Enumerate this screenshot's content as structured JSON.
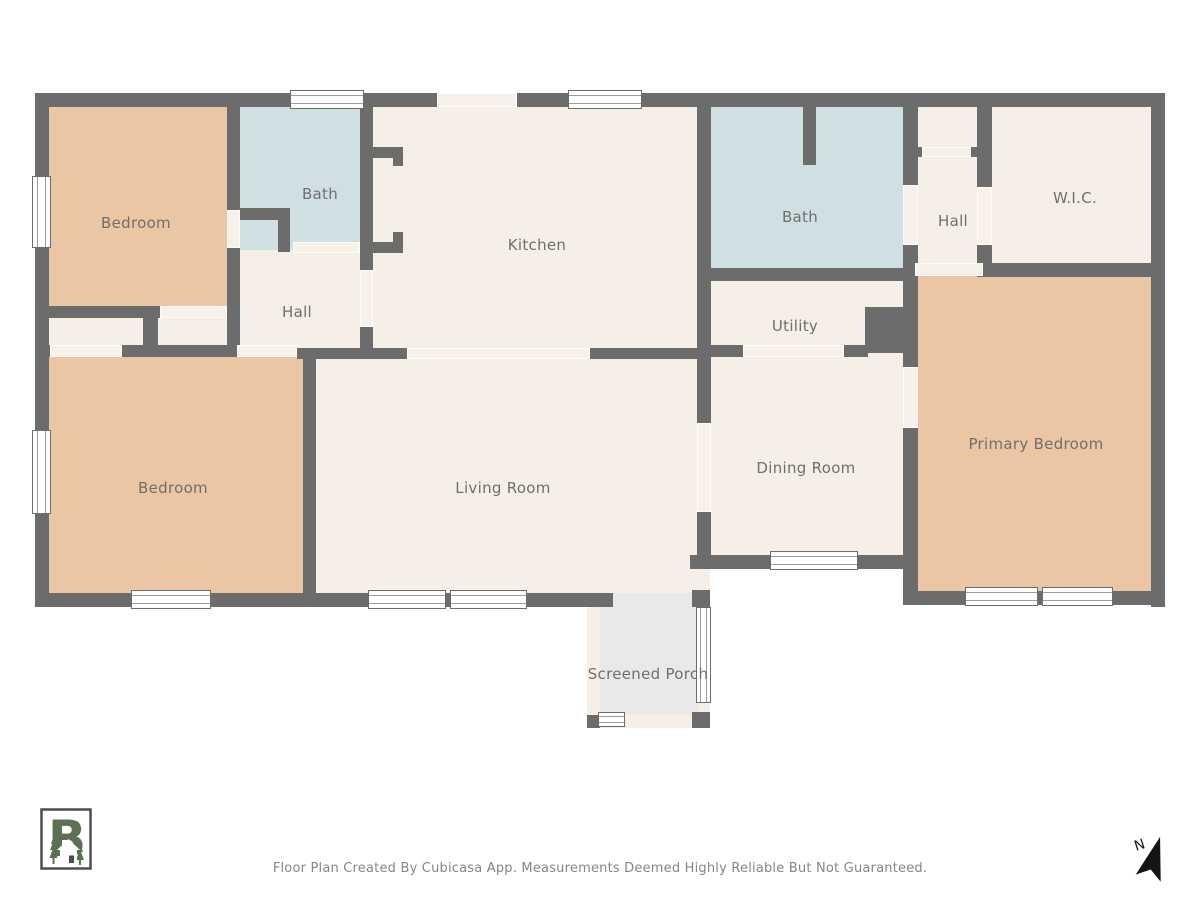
{
  "colors": {
    "wall": "#6c6c6c",
    "floor": "#f6efe7",
    "bedroom": "#ebc6a4",
    "bath": "#cfdfe2",
    "porch": "#e9e9e9",
    "opening": "#f8f1e9",
    "window_fill": "#ffffff",
    "window_frame": "#6c6c6c",
    "window_line": "#9c9c9c",
    "label": "#6f6f6f",
    "logo_green": "#5c7154",
    "footer_text": "#868686"
  },
  "footer": {
    "disclaimer": "Floor Plan Created By Cubicasa App. Measurements Deemed Highly Reliable But Not Guaranteed."
  },
  "north": {
    "label": "N"
  },
  "icons": {
    "logo": "cubicasa-house-logo",
    "north": "north-arrow-icon"
  },
  "plan": {
    "fills": [
      {
        "name": "closets-floor",
        "x": 35,
        "y": 302,
        "w": 203,
        "h": 55,
        "color": "floor"
      },
      {
        "name": "hall-left-floor",
        "x": 227,
        "y": 245,
        "w": 146,
        "h": 112,
        "color": "floor"
      },
      {
        "name": "hall-left-pocket-floor",
        "x": 228,
        "y": 214,
        "w": 64,
        "h": 38,
        "color": "floor"
      },
      {
        "name": "bath-left-floor",
        "x": 237,
        "y": 100,
        "w": 136,
        "h": 150,
        "color": "bath"
      },
      {
        "name": "bedroom-topleft-floor",
        "x": 43,
        "y": 100,
        "w": 195,
        "h": 208,
        "color": "bedroom"
      },
      {
        "name": "kitchen-floor",
        "x": 360,
        "y": 100,
        "w": 350,
        "h": 257,
        "color": "floor"
      },
      {
        "name": "bath-right-floor",
        "x": 703,
        "y": 100,
        "w": 202,
        "h": 170,
        "color": "bath"
      },
      {
        "name": "utility-floor",
        "x": 703,
        "y": 270,
        "w": 202,
        "h": 87,
        "color": "floor"
      },
      {
        "name": "hall-right-floor",
        "x": 908,
        "y": 100,
        "w": 84,
        "h": 177,
        "color": "floor"
      },
      {
        "name": "wic-floor",
        "x": 983,
        "y": 100,
        "w": 182,
        "h": 177,
        "color": "floor"
      },
      {
        "name": "dining-room-floor",
        "x": 697,
        "y": 355,
        "w": 221,
        "h": 214,
        "color": "floor"
      },
      {
        "name": "living-room-floor",
        "x": 310,
        "y": 348,
        "w": 400,
        "h": 247,
        "color": "floor"
      },
      {
        "name": "bedroom-bottomleft-floor",
        "x": 43,
        "y": 355,
        "w": 272,
        "h": 240,
        "color": "bedroom"
      },
      {
        "name": "primary-bedroom-floor",
        "x": 915,
        "y": 273,
        "w": 242,
        "h": 322,
        "color": "bedroom"
      },
      {
        "name": "screened-porch-floor",
        "x": 600,
        "y": 593,
        "w": 98,
        "h": 124,
        "color": "porch"
      },
      {
        "name": "porch-screen-left",
        "x": 587,
        "y": 605,
        "w": 13,
        "h": 112,
        "color": "floor"
      },
      {
        "name": "porch-screen-bottom",
        "x": 598,
        "y": 715,
        "w": 94,
        "h": 13,
        "color": "floor"
      },
      {
        "name": "porch-screen-right",
        "x": 698,
        "y": 607,
        "w": 12,
        "h": 107,
        "color": "floor"
      }
    ],
    "walls": [
      {
        "name": "exterior-wall-top",
        "x": 35,
        "y": 93,
        "w": 1130,
        "h": 14
      },
      {
        "name": "exterior-wall-left",
        "x": 35,
        "y": 93,
        "w": 14,
        "h": 514
      },
      {
        "name": "exterior-wall-right",
        "x": 1151,
        "y": 93,
        "w": 14,
        "h": 514
      },
      {
        "name": "exterior-wall-bottom-left",
        "x": 35,
        "y": 593,
        "w": 578,
        "h": 14
      },
      {
        "name": "dining-bottom-wall",
        "x": 690,
        "y": 555,
        "w": 228,
        "h": 14
      },
      {
        "name": "primary-bottom-wall",
        "x": 905,
        "y": 591,
        "w": 260,
        "h": 14
      },
      {
        "name": "porch-post-topright",
        "x": 692,
        "y": 590,
        "w": 18,
        "h": 17
      },
      {
        "name": "porch-post-bottomleft",
        "x": 587,
        "y": 715,
        "w": 13,
        "h": 13
      },
      {
        "name": "porch-post-bottomright",
        "x": 692,
        "y": 712,
        "w": 18,
        "h": 16
      },
      {
        "name": "bedroom1-right-wall-upper",
        "x": 227,
        "y": 100,
        "w": 13,
        "h": 110
      },
      {
        "name": "bedroom1-right-wall-lower",
        "x": 227,
        "y": 248,
        "w": 13,
        "h": 104
      },
      {
        "name": "bath1-l-wall-horizontal",
        "x": 232,
        "y": 208,
        "w": 58,
        "h": 12
      },
      {
        "name": "bath1-l-wall-vertical",
        "x": 278,
        "y": 208,
        "w": 12,
        "h": 44
      },
      {
        "name": "kitchen-left-wall",
        "x": 360,
        "y": 98,
        "w": 13,
        "h": 172
      },
      {
        "name": "kitchen-pantry-stub-top",
        "x": 372,
        "y": 147,
        "w": 31,
        "h": 11
      },
      {
        "name": "kitchen-pantry-jamb-top",
        "x": 393,
        "y": 156,
        "w": 10,
        "h": 10
      },
      {
        "name": "kitchen-pantry-stub-bottom",
        "x": 372,
        "y": 242,
        "w": 31,
        "h": 11
      },
      {
        "name": "kitchen-pantry-jamb-bottom",
        "x": 393,
        "y": 232,
        "w": 10,
        "h": 10
      },
      {
        "name": "kitchen-left-wall-stub",
        "x": 360,
        "y": 327,
        "w": 13,
        "h": 23
      },
      {
        "name": "bedroom1-bottom-wall",
        "x": 43,
        "y": 306,
        "w": 118,
        "h": 12
      },
      {
        "name": "closet-divider-wall",
        "x": 143,
        "y": 306,
        "w": 15,
        "h": 47
      },
      {
        "name": "closets-bottom-wall",
        "x": 122,
        "y": 345,
        "w": 116,
        "h": 12
      },
      {
        "name": "bottom-wall-stub-left",
        "x": 35,
        "y": 345,
        "w": 16,
        "h": 12
      },
      {
        "name": "living-top-wall-left",
        "x": 297,
        "y": 348,
        "w": 111,
        "h": 11
      },
      {
        "name": "living-top-wall-right",
        "x": 590,
        "y": 348,
        "w": 120,
        "h": 11
      },
      {
        "name": "kitchen-right-wall",
        "x": 697,
        "y": 100,
        "w": 14,
        "h": 323
      },
      {
        "name": "dining-left-wall-lower",
        "x": 697,
        "y": 512,
        "w": 14,
        "h": 57
      },
      {
        "name": "bedroom2-right-wall",
        "x": 303,
        "y": 350,
        "w": 13,
        "h": 245
      },
      {
        "name": "bath2-bottom-wall",
        "x": 703,
        "y": 268,
        "w": 208,
        "h": 13
      },
      {
        "name": "bath2-stub-wall",
        "x": 803,
        "y": 100,
        "w": 13,
        "h": 65
      },
      {
        "name": "utility-block",
        "x": 865,
        "y": 307,
        "w": 46,
        "h": 46
      },
      {
        "name": "utility-bottom-wall-left",
        "x": 703,
        "y": 345,
        "w": 41,
        "h": 12
      },
      {
        "name": "utility-bottom-wall-right",
        "x": 844,
        "y": 345,
        "w": 24,
        "h": 12
      },
      {
        "name": "hall2-left-wall-upper",
        "x": 903,
        "y": 100,
        "w": 15,
        "h": 85
      },
      {
        "name": "hall2-left-wall-lower",
        "x": 903,
        "y": 245,
        "w": 15,
        "h": 122
      },
      {
        "name": "dining-primary-wall",
        "x": 903,
        "y": 428,
        "w": 15,
        "h": 177
      },
      {
        "name": "hall2-right-wall-upper",
        "x": 977,
        "y": 100,
        "w": 15,
        "h": 87
      },
      {
        "name": "hall2-right-wall-lower",
        "x": 977,
        "y": 245,
        "w": 15,
        "h": 32
      },
      {
        "name": "wic-bottom-wall",
        "x": 983,
        "y": 263,
        "w": 182,
        "h": 14
      },
      {
        "name": "hall2-closet-jamb-left",
        "x": 915,
        "y": 147,
        "w": 7,
        "h": 10
      },
      {
        "name": "hall2-closet-jamb-right",
        "x": 971,
        "y": 147,
        "w": 8,
        "h": 10
      }
    ],
    "openings": [
      {
        "name": "front-door-opening",
        "x": 437,
        "y": 93,
        "w": 80,
        "h": 14
      },
      {
        "name": "bedroom1-door-opening",
        "x": 227,
        "y": 210,
        "w": 13,
        "h": 38
      },
      {
        "name": "bath1-door-opening",
        "x": 293,
        "y": 242,
        "w": 67,
        "h": 11
      },
      {
        "name": "hall-kitchen-door-opening",
        "x": 360,
        "y": 270,
        "w": 13,
        "h": 57
      },
      {
        "name": "bedroom2-door-opening",
        "x": 237,
        "y": 345,
        "w": 60,
        "h": 12
      },
      {
        "name": "closet1-opening",
        "x": 50,
        "y": 345,
        "w": 72,
        "h": 12
      },
      {
        "name": "closet2-opening",
        "x": 160,
        "y": 306,
        "w": 67,
        "h": 12
      },
      {
        "name": "kitchen-living-opening",
        "x": 407,
        "y": 348,
        "w": 183,
        "h": 11
      },
      {
        "name": "living-dining-opening",
        "x": 697,
        "y": 423,
        "w": 14,
        "h": 89
      },
      {
        "name": "utility-dining-opening",
        "x": 743,
        "y": 345,
        "w": 101,
        "h": 12
      },
      {
        "name": "bath2-door-opening",
        "x": 903,
        "y": 185,
        "w": 15,
        "h": 60
      },
      {
        "name": "wic-door-opening",
        "x": 977,
        "y": 187,
        "w": 15,
        "h": 58
      },
      {
        "name": "primary-entry-opening",
        "x": 915,
        "y": 263,
        "w": 68,
        "h": 13
      },
      {
        "name": "dining-primary-door-opening",
        "x": 903,
        "y": 367,
        "w": 15,
        "h": 61
      },
      {
        "name": "hall2-closet-door",
        "x": 922,
        "y": 147,
        "w": 49,
        "h": 10
      }
    ],
    "windows": [
      {
        "name": "window-bath1-top",
        "x": 290,
        "y": 90,
        "w": 74,
        "h": 19,
        "dir": "h"
      },
      {
        "name": "window-kitchen-top",
        "x": 568,
        "y": 90,
        "w": 74,
        "h": 19,
        "dir": "h"
      },
      {
        "name": "window-bedroom1-left",
        "x": 32,
        "y": 176,
        "w": 19,
        "h": 72,
        "dir": "v"
      },
      {
        "name": "window-bedroom2-left",
        "x": 32,
        "y": 430,
        "w": 19,
        "h": 84,
        "dir": "v"
      },
      {
        "name": "window-bedroom2-bottom",
        "x": 131,
        "y": 590,
        "w": 80,
        "h": 19,
        "dir": "h"
      },
      {
        "name": "window-living-bottom-1",
        "x": 368,
        "y": 590,
        "w": 78,
        "h": 19,
        "dir": "h"
      },
      {
        "name": "window-living-bottom-2",
        "x": 450,
        "y": 590,
        "w": 77,
        "h": 19,
        "dir": "h"
      },
      {
        "name": "window-dining-bottom",
        "x": 770,
        "y": 551,
        "w": 88,
        "h": 19,
        "dir": "h"
      },
      {
        "name": "window-primary-bottom-1",
        "x": 965,
        "y": 587,
        "w": 73,
        "h": 19,
        "dir": "h"
      },
      {
        "name": "window-primary-bottom-2",
        "x": 1042,
        "y": 587,
        "w": 71,
        "h": 19,
        "dir": "h"
      },
      {
        "name": "window-porch-right",
        "x": 696,
        "y": 607,
        "w": 15,
        "h": 96,
        "dir": "v"
      },
      {
        "name": "window-porch-bottom",
        "x": 598,
        "y": 712,
        "w": 27,
        "h": 15,
        "dir": "h"
      }
    ],
    "labels": [
      {
        "name": "room-label-bedroom-topleft",
        "text": "Bedroom",
        "x": 136,
        "y": 223
      },
      {
        "name": "room-label-bath-left",
        "text": "Bath",
        "x": 320,
        "y": 194
      },
      {
        "name": "room-label-kitchen",
        "text": "Kitchen",
        "x": 537,
        "y": 245
      },
      {
        "name": "room-label-bath-right",
        "text": "Bath",
        "x": 800,
        "y": 217
      },
      {
        "name": "room-label-hall-right",
        "text": "Hall",
        "x": 953,
        "y": 221
      },
      {
        "name": "room-label-wic",
        "text": "W.I.C.",
        "x": 1075,
        "y": 198
      },
      {
        "name": "room-label-hall-left",
        "text": "Hall",
        "x": 297,
        "y": 312
      },
      {
        "name": "room-label-utility",
        "text": "Utility",
        "x": 795,
        "y": 326
      },
      {
        "name": "room-label-bedroom-bottomleft",
        "text": "Bedroom",
        "x": 173,
        "y": 488
      },
      {
        "name": "room-label-living-room",
        "text": "Living Room",
        "x": 503,
        "y": 488
      },
      {
        "name": "room-label-dining-room",
        "text": "Dining Room",
        "x": 806,
        "y": 468
      },
      {
        "name": "room-label-primary-bedroom",
        "text": "Primary Bedroom",
        "x": 1036,
        "y": 444
      },
      {
        "name": "room-label-screened-porch",
        "text": "Screened Porch",
        "x": 648,
        "y": 674
      }
    ]
  }
}
